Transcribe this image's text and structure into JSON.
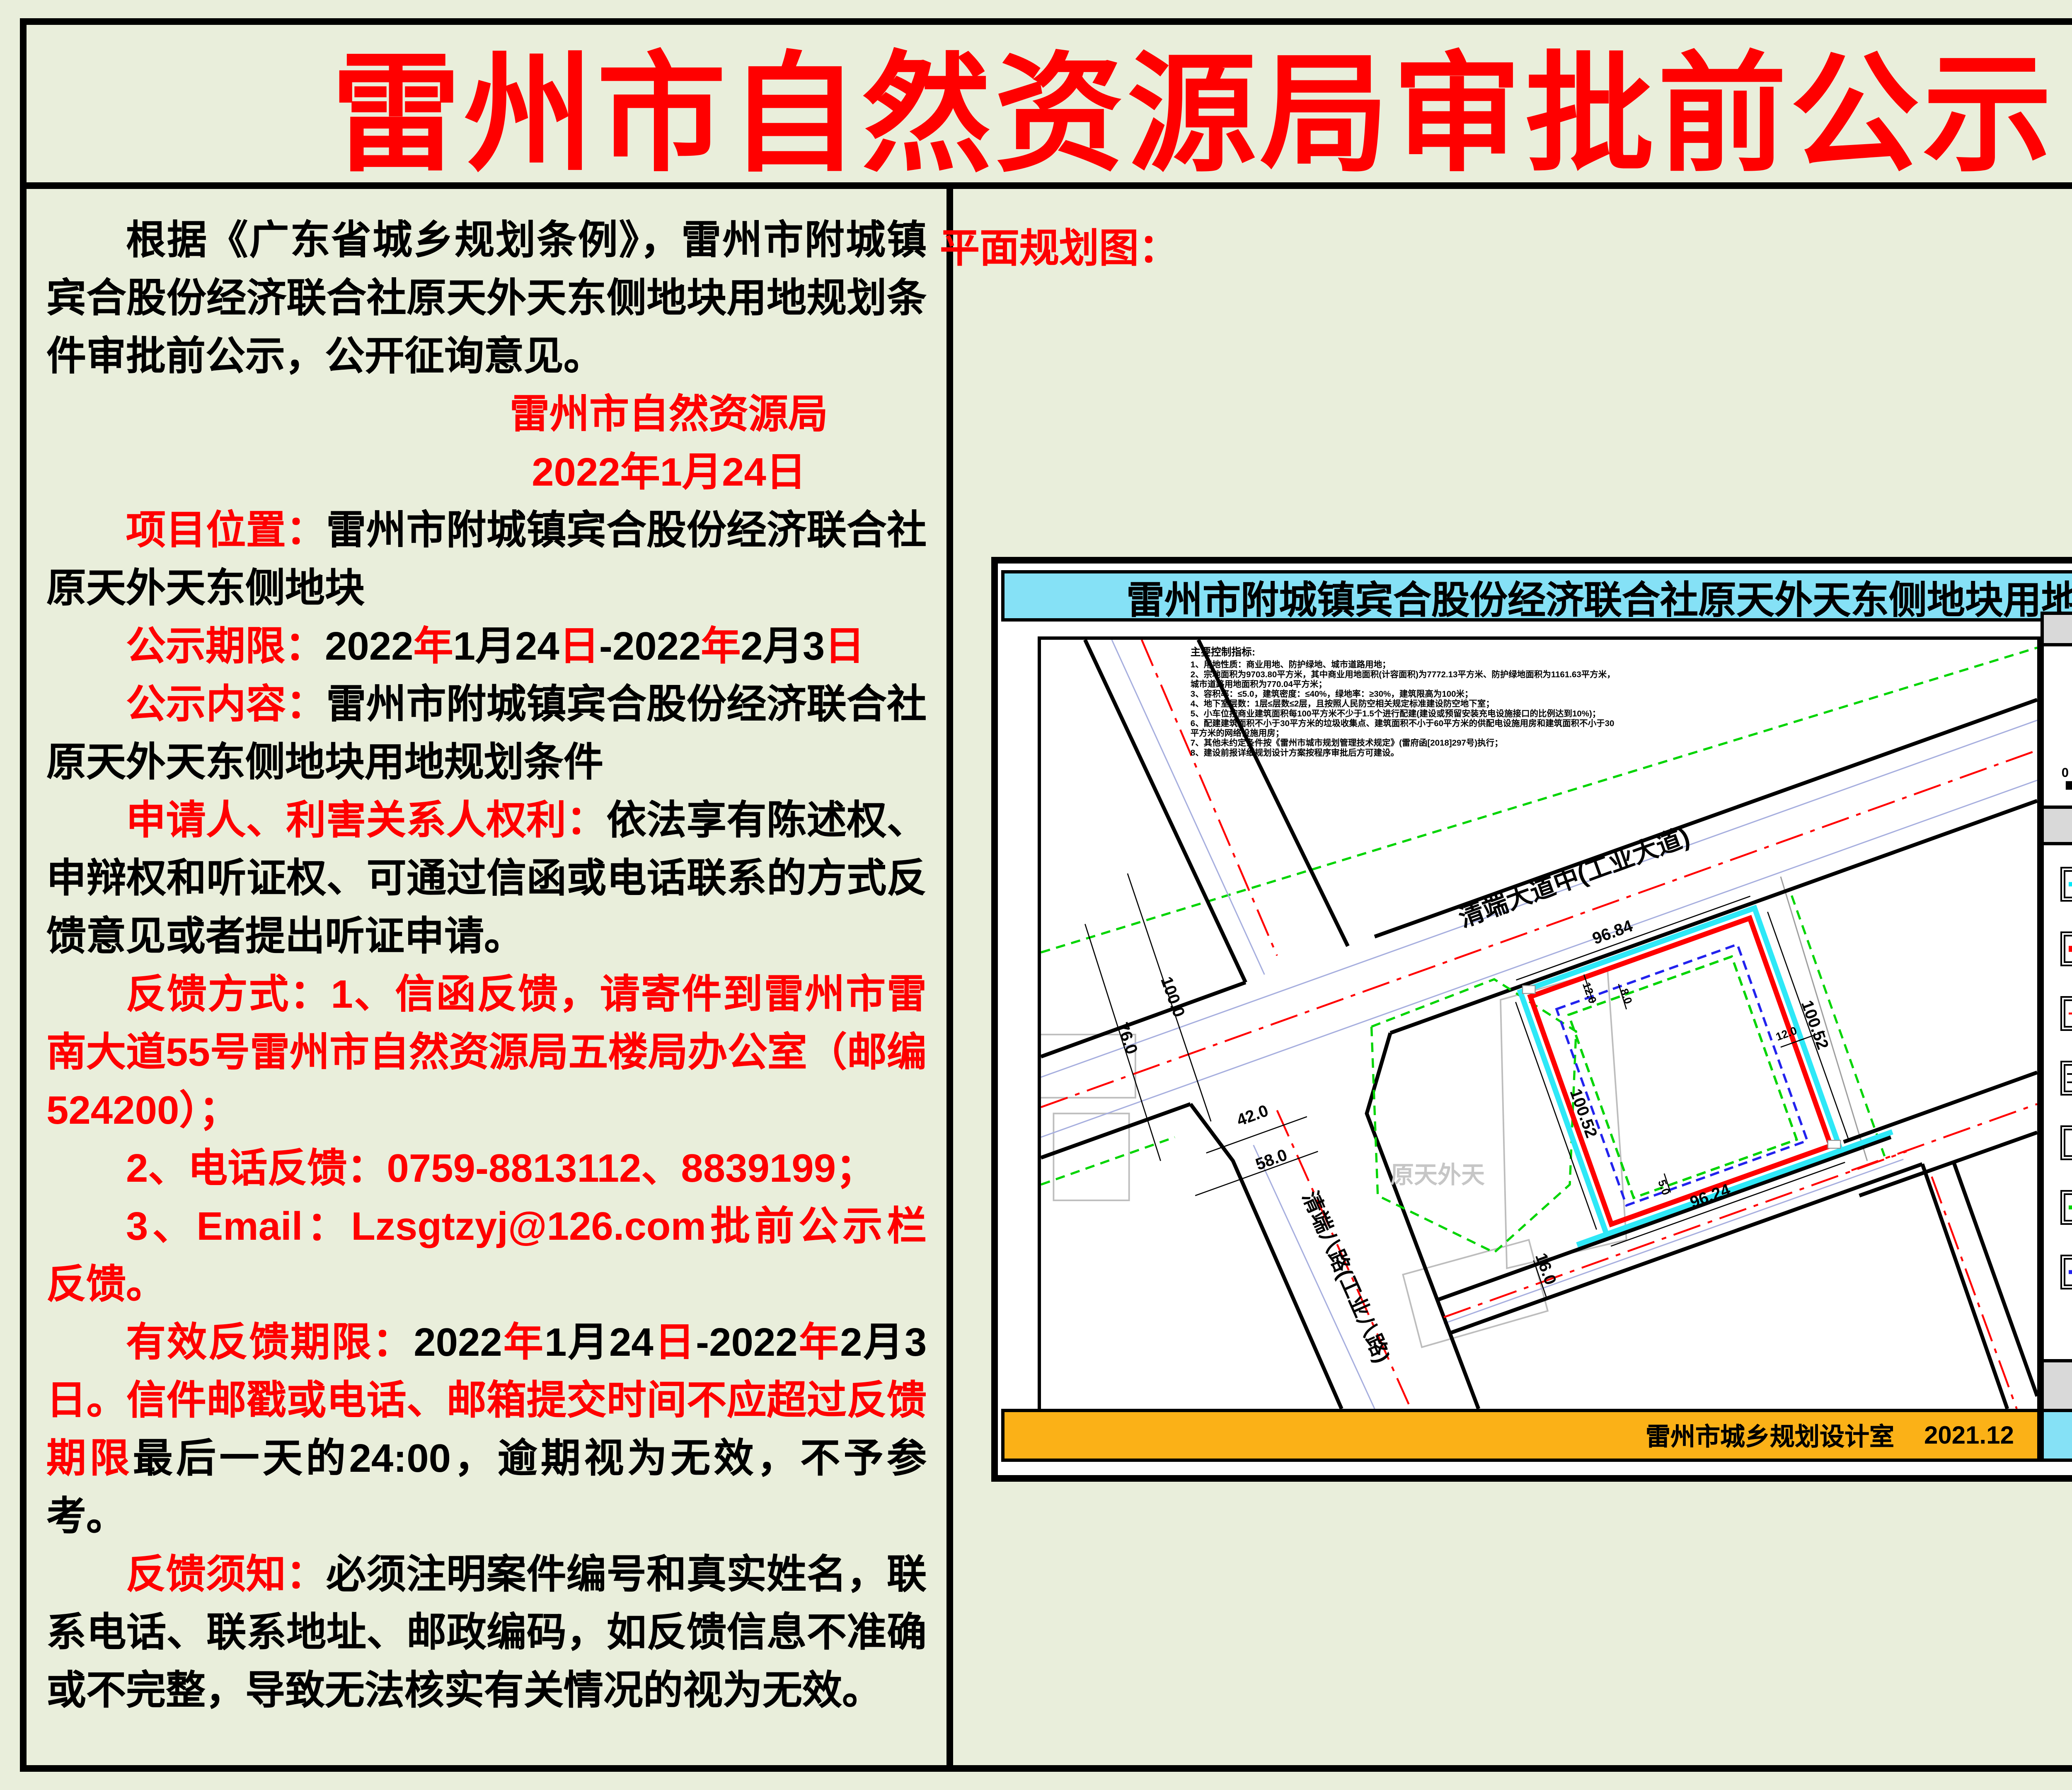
{
  "page": {
    "title": "雷州市自然资源局审批前公示",
    "title_color": "#ff0000",
    "background": "#e9eedb"
  },
  "notice": {
    "paragraphs": [
      {
        "runs": [
          {
            "t": "根据《广东省城乡规划条例》，雷州市附城镇宾合股份经济联合社原天外天东侧地块用地规划条件审批前公示，公开征询意见。",
            "c": "k"
          }
        ]
      },
      {
        "align": "sig",
        "runs": [
          {
            "t": "雷州市自然资源局",
            "c": "r"
          }
        ]
      },
      {
        "align": "sig",
        "runs": [
          {
            "t": "2022年1月24日",
            "c": "r"
          }
        ]
      },
      {
        "runs": [
          {
            "t": "项目位置：",
            "c": "r"
          },
          {
            "t": "雷州市附城镇宾合股份经济联合社原天外天东侧地块",
            "c": "k"
          }
        ]
      },
      {
        "runs": [
          {
            "t": "公示期限：",
            "c": "r"
          },
          {
            "t": "2022",
            "c": "k"
          },
          {
            "t": "年",
            "c": "r"
          },
          {
            "t": "1",
            "c": "k"
          },
          {
            "t": "月",
            "c": "k"
          },
          {
            "t": "24",
            "c": "k"
          },
          {
            "t": "日",
            "c": "r"
          },
          {
            "t": "-",
            "c": "k"
          },
          {
            "t": "2022",
            "c": "k"
          },
          {
            "t": "年",
            "c": "r"
          },
          {
            "t": "2",
            "c": "k"
          },
          {
            "t": "月",
            "c": "k"
          },
          {
            "t": "3",
            "c": "k"
          },
          {
            "t": "日",
            "c": "r"
          }
        ]
      },
      {
        "runs": [
          {
            "t": "公示内容：",
            "c": "r"
          },
          {
            "t": "雷州市附城镇宾合股份经济联合社原天外天东侧地块用地规划条件",
            "c": "k"
          }
        ]
      },
      {
        "runs": [
          {
            "t": "申请人、利害关系人权利：",
            "c": "r"
          },
          {
            "t": "依法享有陈述权、申辩权和听证权、可通过信函或电话联系的方式反馈意见或者提出听证申请。",
            "c": "k"
          }
        ]
      },
      {
        "runs": [
          {
            "t": "反馈方式：1、信函反馈，请寄件到雷州市雷南大道55号雷州市自然资源局五楼局办公室（邮编524200）；",
            "c": "r"
          }
        ]
      },
      {
        "runs": [
          {
            "t": "2、电话反馈：0759-8813112、8839199；",
            "c": "r"
          }
        ]
      },
      {
        "runs": [
          {
            "t": "3、Email：Lzsgtzyj@126.com批前公示栏反馈。",
            "c": "r"
          }
        ]
      },
      {
        "runs": [
          {
            "t": "有效反馈期限：",
            "c": "r"
          },
          {
            "t": "2022",
            "c": "k"
          },
          {
            "t": "年",
            "c": "r"
          },
          {
            "t": "1",
            "c": "k"
          },
          {
            "t": "月",
            "c": "k"
          },
          {
            "t": "24",
            "c": "k"
          },
          {
            "t": "日",
            "c": "r"
          },
          {
            "t": "-",
            "c": "k"
          },
          {
            "t": "2022",
            "c": "k"
          },
          {
            "t": "年",
            "c": "r"
          },
          {
            "t": "2",
            "c": "k"
          },
          {
            "t": "月",
            "c": "k"
          },
          {
            "t": "3",
            "c": "k"
          },
          {
            "t": "日",
            "c": "r"
          },
          {
            "t": "。信件邮戳或电话、邮箱提交时间不应超过反馈期限",
            "c": "r"
          },
          {
            "t": "最后一天的24:00，逾期视为无效，不予参考。",
            "c": "k"
          }
        ]
      },
      {
        "runs": [
          {
            "t": "反馈须知：",
            "c": "r"
          },
          {
            "t": "必须注明案件编号和真实姓名，联系电话、联系地址、邮政编码，如反馈信息不准确或不完整，导致无法核实有关情况的视为无效。",
            "c": "k"
          }
        ]
      }
    ]
  },
  "plan": {
    "label": "平面规划图：",
    "map_title": "雷州市附城镇宾合股份经济联合社原天外天东侧地块用地规划",
    "indicators": {
      "title": "主要控制指标:",
      "lines": [
        "1、用地性质：商业用地、防护绿地、城市道路用地；",
        "2、宗地面积为9703.80平方米，其中商业用地面积(计容面积)为7772.13平方米、防护绿地面积为1161.63平方米，",
        "城市道路用地面积为770.04平方米；",
        "3、容积率：≤5.0，建筑密度：≤40%，绿地率：≥30%，建筑限高为100米；",
        "4、地下室层数：1层≤层数≤2层，且按照人民防空相关规定标准建设防空地下室；",
        "5、小车位按商业建筑面积每100平方米不少于1.5个进行配建(建设或预留安装充电设施接口的比例达到10%)；",
        "6、配建建筑面积不小于30平方米的垃圾收集点、建筑面积不小于60平方米的供配电设施用房和建筑面积不小于30",
        "平方米的网络设施用房；",
        "7、其他未约定条件按《雷州市城市规划管理技术规定》(雷府函[2018]297号)执行；",
        "8、建设前报详细规划设计方案按程序审批后方可建设。"
      ]
    },
    "roads": {
      "main": "清端大道中(工业大道)",
      "secondary": "清端八路(工业八路)"
    },
    "site_label": "原天外天",
    "dimensions": {
      "top": "96.84",
      "bottom": "96.24",
      "left": "100.52",
      "right": "100.52",
      "road_width_1": "76.0",
      "road_width_2": "100.0",
      "branch_width_1": "42.0",
      "branch_width_2": "58.0",
      "south_road": "16.0",
      "setback_top_1": "12.0",
      "setback_top_2": "8.0",
      "setback_right": "12.0",
      "setback_bottom": "5.0"
    },
    "sidebar": {
      "windrose_title": "风玫瑰图",
      "north": "N",
      "scale": {
        "s0": "0",
        "s20": "20",
        "s40": "40",
        "s80": "80M"
      },
      "legend_title": "图 例",
      "legend": [
        {
          "label": "宗地红线",
          "type": "solid",
          "color": "#00e8f8"
        },
        {
          "label": "用地规划红线",
          "type": "thick",
          "color": "#ff0000"
        },
        {
          "label": "道路中心线",
          "type": "dashdot",
          "color": "#ff0000"
        },
        {
          "label": "道路红线",
          "type": "road",
          "color": "#000000"
        },
        {
          "label": "控制点坐标",
          "type": "empty",
          "color": "#000000"
        },
        {
          "label": "地上建筑控制线",
          "type": "dashed",
          "color": "#00d400"
        },
        {
          "label": "地下建筑控制线",
          "type": "dashed",
          "color": "#2222ee"
        }
      ],
      "intensity_title": "开发强度控制图"
    },
    "footer": {
      "author": "雷州市城乡规划设计室",
      "date": "2021.12"
    },
    "colors": {
      "parcel_cyan": "#2ee8f7",
      "red_line": "#ff0000",
      "green_ctrl": "#00d400",
      "blue_ctrl": "#2222ee",
      "orange_bar": "#fbb117",
      "title_bar": "#85e1f6"
    }
  }
}
